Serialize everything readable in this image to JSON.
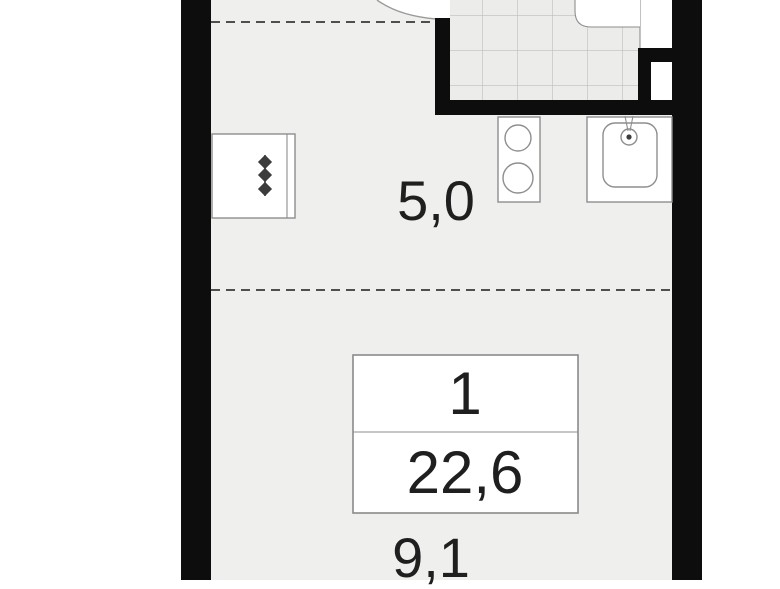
{
  "plan": {
    "type": "apartment-floor-plan",
    "unit_box": {
      "number": "1",
      "area": "22,6"
    },
    "labels": {
      "kitchen_area": "5,0",
      "room_area": "9,1"
    },
    "colors": {
      "wall": "#0d0d0d",
      "floor": "#efefed",
      "tile_bg": "#ececea",
      "tile_line": "#bdbdbd",
      "fixture_stroke": "#8e8e8e",
      "box_border": "#8a8a8a",
      "dash_line": "#4f4f4f",
      "symbol": "#3c3c3c",
      "text": "#1f1f1f",
      "page_bg": "#ffffff"
    }
  }
}
